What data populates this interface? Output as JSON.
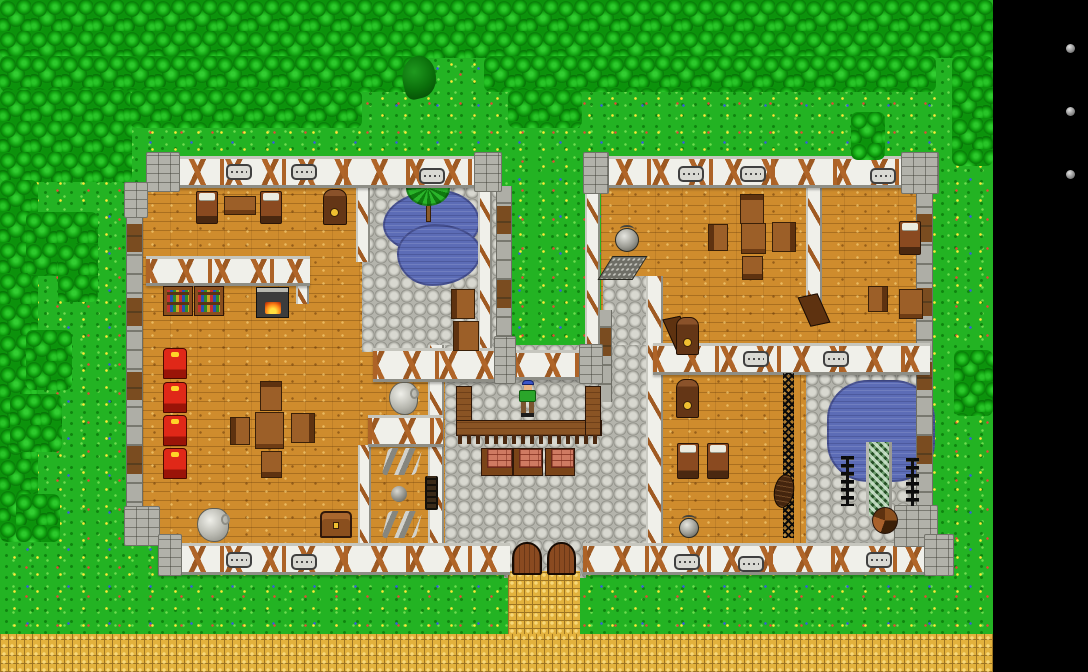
{
  "meta": {
    "description": "Top-down tile RPG scene: timber-framed building complex in a forest clearing with market hall, bedrooms, library, ponds and a villager",
    "viewport": {
      "width": 1088,
      "height": 672
    },
    "map_area": {
      "width": 993,
      "height": 672
    }
  },
  "palette": {
    "grass": "#23b323",
    "tree": "#0c930c",
    "wood_floor": "#cf8c2d",
    "cobble": "#b4b4ac",
    "wall_plaster": "#f0f0ea",
    "wall_brace": "#ad6327",
    "stone": "#aeaea6",
    "water": "#5c6cb6",
    "path": "#e3b23d",
    "panel": "#000000",
    "panel_dot": "#909090",
    "avatar_cap": "#3a55c8",
    "avatar_shirt": "#2aa52a",
    "avatar_pants": "#7a5530",
    "accent_red": "#e02818",
    "accent_gold": "#f0c030"
  },
  "sidebar": {
    "background": "#000000",
    "buttons": [
      {
        "label": "orb-button-1",
        "x": 1066,
        "y": 44,
        "size": 9
      },
      {
        "label": "orb-button-2",
        "x": 1066,
        "y": 107,
        "size": 9
      },
      {
        "label": "orb-button-3",
        "x": 1066,
        "y": 170,
        "size": 9
      }
    ]
  },
  "entities": [
    {
      "t": "floor-wood",
      "x": 143,
      "y": 186,
      "w": 302,
      "h": 360
    },
    {
      "t": "floor-cobble",
      "x": 362,
      "y": 186,
      "w": 150,
      "h": 166
    },
    {
      "t": "floor-wood",
      "x": 601,
      "y": 186,
      "w": 317,
      "h": 164
    },
    {
      "t": "floor-cobble",
      "x": 603,
      "y": 276,
      "w": 45,
      "h": 124
    },
    {
      "t": "floor-wood",
      "x": 661,
      "y": 373,
      "w": 132,
      "h": 173
    },
    {
      "t": "floor-wood-v",
      "x": 793,
      "y": 373,
      "w": 16,
      "h": 173
    },
    {
      "t": "floor-cobble",
      "x": 806,
      "y": 373,
      "w": 127,
      "h": 173
    },
    {
      "t": "floor-cobble",
      "x": 445,
      "y": 345,
      "w": 212,
      "h": 201
    },
    {
      "t": "floor-cobble",
      "x": 504,
      "y": 540,
      "w": 82,
      "h": 38
    },
    {
      "t": "path",
      "x": 508,
      "y": 571,
      "w": 72,
      "h": 66
    },
    {
      "t": "path",
      "x": 0,
      "y": 634,
      "w": 993,
      "h": 38
    },
    {
      "t": "pond-a",
      "x": 383,
      "y": 190,
      "w": 97,
      "h": 64
    },
    {
      "t": "pond-b",
      "x": 397,
      "y": 224,
      "w": 84,
      "h": 62
    },
    {
      "t": "pond-c",
      "x": 827,
      "y": 380,
      "w": 108,
      "h": 102
    },
    {
      "t": "palm-tree",
      "x": 406,
      "y": 170,
      "w": 44,
      "h": 52
    },
    {
      "t": "wall-stone",
      "x": 126,
      "y": 184,
      "w": 17,
      "h": 336
    },
    {
      "t": "wall-stone",
      "x": 916,
      "y": 184,
      "w": 17,
      "h": 326
    },
    {
      "t": "wall-stone2",
      "x": 496,
      "y": 186,
      "w": 16,
      "h": 168
    },
    {
      "t": "wall-stone2",
      "x": 598,
      "y": 310,
      "w": 14,
      "h": 92
    },
    {
      "t": "wall-v",
      "x": 356,
      "y": 186,
      "w": 14,
      "h": 76
    },
    {
      "t": "wall-v",
      "x": 478,
      "y": 186,
      "w": 14,
      "h": 166
    },
    {
      "t": "wall-v",
      "x": 585,
      "y": 190,
      "w": 15,
      "h": 162
    },
    {
      "t": "wall-v",
      "x": 428,
      "y": 345,
      "w": 16,
      "h": 200
    },
    {
      "t": "wall-v",
      "x": 646,
      "y": 276,
      "w": 17,
      "h": 269
    },
    {
      "t": "wall-v",
      "x": 806,
      "y": 158,
      "w": 16,
      "h": 148
    },
    {
      "t": "wall-v",
      "x": 358,
      "y": 445,
      "w": 13,
      "h": 100
    },
    {
      "t": "wall-v",
      "x": 296,
      "y": 256,
      "w": 13,
      "h": 48
    },
    {
      "t": "wall-h",
      "x": 158,
      "y": 156,
      "w": 334,
      "h": 32
    },
    {
      "t": "wall-h",
      "x": 585,
      "y": 156,
      "w": 350,
      "h": 32
    },
    {
      "t": "wall-h",
      "x": 146,
      "y": 256,
      "w": 164,
      "h": 30
    },
    {
      "t": "wall-h",
      "x": 373,
      "y": 348,
      "w": 140,
      "h": 34
    },
    {
      "t": "wall-h",
      "x": 513,
      "y": 350,
      "w": 88,
      "h": 30
    },
    {
      "t": "wall-h",
      "x": 653,
      "y": 343,
      "w": 277,
      "h": 32
    },
    {
      "t": "wall-h",
      "x": 368,
      "y": 415,
      "w": 75,
      "h": 32
    },
    {
      "t": "wall-h",
      "x": 158,
      "y": 543,
      "w": 352,
      "h": 32
    },
    {
      "t": "wall-h",
      "x": 583,
      "y": 543,
      "w": 352,
      "h": 32
    },
    {
      "t": "stone-block",
      "x": 146,
      "y": 152,
      "w": 34,
      "h": 40
    },
    {
      "t": "stone-block",
      "x": 124,
      "y": 182,
      "w": 24,
      "h": 36
    },
    {
      "t": "stone-block",
      "x": 124,
      "y": 506,
      "w": 36,
      "h": 40
    },
    {
      "t": "stone-block",
      "x": 158,
      "y": 534,
      "w": 24,
      "h": 42
    },
    {
      "t": "stone-block",
      "x": 474,
      "y": 152,
      "w": 28,
      "h": 40
    },
    {
      "t": "stone-block",
      "x": 583,
      "y": 152,
      "w": 26,
      "h": 42
    },
    {
      "t": "stone-block",
      "x": 901,
      "y": 152,
      "w": 38,
      "h": 42
    },
    {
      "t": "stone-block",
      "x": 894,
      "y": 505,
      "w": 44,
      "h": 42
    },
    {
      "t": "stone-block",
      "x": 924,
      "y": 534,
      "w": 30,
      "h": 42
    },
    {
      "t": "stone-block",
      "x": 494,
      "y": 336,
      "w": 22,
      "h": 48
    },
    {
      "t": "stone-block",
      "x": 579,
      "y": 344,
      "w": 24,
      "h": 40
    },
    {
      "t": "window",
      "x": 226,
      "y": 164,
      "w": 26,
      "h": 16
    },
    {
      "t": "window",
      "x": 291,
      "y": 164,
      "w": 26,
      "h": 16
    },
    {
      "t": "window",
      "x": 419,
      "y": 168,
      "w": 26,
      "h": 16
    },
    {
      "t": "window",
      "x": 678,
      "y": 166,
      "w": 26,
      "h": 16
    },
    {
      "t": "window",
      "x": 740,
      "y": 166,
      "w": 26,
      "h": 16
    },
    {
      "t": "window",
      "x": 870,
      "y": 168,
      "w": 26,
      "h": 16
    },
    {
      "t": "window",
      "x": 743,
      "y": 351,
      "w": 26,
      "h": 16
    },
    {
      "t": "window",
      "x": 823,
      "y": 351,
      "w": 26,
      "h": 16
    },
    {
      "t": "window",
      "x": 226,
      "y": 552,
      "w": 26,
      "h": 16
    },
    {
      "t": "window",
      "x": 291,
      "y": 554,
      "w": 26,
      "h": 16
    },
    {
      "t": "window",
      "x": 674,
      "y": 554,
      "w": 26,
      "h": 16
    },
    {
      "t": "window",
      "x": 738,
      "y": 556,
      "w": 26,
      "h": 16
    },
    {
      "t": "window",
      "x": 866,
      "y": 552,
      "w": 26,
      "h": 16
    },
    {
      "t": "open-door",
      "x": 804,
      "y": 294,
      "w": 20,
      "h": 32
    },
    {
      "t": "open-door",
      "x": 670,
      "y": 316,
      "w": 18,
      "h": 38
    },
    {
      "t": "bed",
      "x": 196,
      "y": 191,
      "w": 22,
      "h": 33
    },
    {
      "t": "side-table",
      "x": 224,
      "y": 196,
      "w": 32,
      "h": 19
    },
    {
      "t": "bed",
      "x": 260,
      "y": 191,
      "w": 22,
      "h": 33
    },
    {
      "t": "clock",
      "x": 323,
      "y": 189,
      "w": 24,
      "h": 36
    },
    {
      "t": "bookshelf",
      "x": 163,
      "y": 286,
      "w": 30,
      "h": 30
    },
    {
      "t": "bookshelf",
      "x": 194,
      "y": 286,
      "w": 30,
      "h": 30
    },
    {
      "t": "stove",
      "x": 256,
      "y": 287,
      "w": 33,
      "h": 31
    },
    {
      "t": "red-chair",
      "x": 163,
      "y": 348,
      "w": 24,
      "h": 31
    },
    {
      "t": "red-chair",
      "x": 163,
      "y": 382,
      "w": 24,
      "h": 31
    },
    {
      "t": "red-chair",
      "x": 163,
      "y": 415,
      "w": 24,
      "h": 31
    },
    {
      "t": "red-chair",
      "x": 163,
      "y": 448,
      "w": 24,
      "h": 31
    },
    {
      "t": "chair-n",
      "x": 260,
      "y": 381,
      "w": 22,
      "h": 30
    },
    {
      "t": "chair-w",
      "x": 230,
      "y": 417,
      "w": 20,
      "h": 28
    },
    {
      "t": "table",
      "x": 255,
      "y": 412,
      "w": 29,
      "h": 37
    },
    {
      "t": "chair-e",
      "x": 291,
      "y": 413,
      "w": 24,
      "h": 30
    },
    {
      "t": "chair-s",
      "x": 261,
      "y": 451,
      "w": 21,
      "h": 27
    },
    {
      "t": "pitcher",
      "x": 389,
      "y": 382,
      "w": 29,
      "h": 33
    },
    {
      "t": "pitcher",
      "x": 197,
      "y": 508,
      "w": 32,
      "h": 34
    },
    {
      "t": "gray-rolls",
      "x": 385,
      "y": 448,
      "w": 34,
      "h": 27
    },
    {
      "t": "gray-rolls",
      "x": 385,
      "y": 511,
      "w": 34,
      "h": 27
    },
    {
      "t": "ball",
      "x": 391,
      "y": 486,
      "w": 16,
      "h": 16
    },
    {
      "t": "ladder",
      "x": 425,
      "y": 476,
      "w": 13,
      "h": 34
    },
    {
      "t": "chest",
      "x": 320,
      "y": 511,
      "w": 32,
      "h": 27
    },
    {
      "t": "chair-w",
      "x": 451,
      "y": 289,
      "w": 24,
      "h": 30
    },
    {
      "t": "chair-w",
      "x": 453,
      "y": 321,
      "w": 26,
      "h": 30
    },
    {
      "t": "counter-l",
      "x": 456,
      "y": 386,
      "w": 16,
      "h": 50
    },
    {
      "t": "counter-b",
      "x": 456,
      "y": 420,
      "w": 146,
      "h": 16
    },
    {
      "t": "counter-r",
      "x": 585,
      "y": 386,
      "w": 16,
      "h": 50
    },
    {
      "t": "fringe",
      "x": 458,
      "y": 435,
      "w": 142,
      "h": 9
    },
    {
      "t": "stall",
      "x": 481,
      "y": 448,
      "w": 32,
      "h": 28
    },
    {
      "t": "stall",
      "x": 513,
      "y": 448,
      "w": 30,
      "h": 28
    },
    {
      "t": "stall",
      "x": 545,
      "y": 448,
      "w": 30,
      "h": 28
    },
    {
      "t": "door-arch",
      "x": 512,
      "y": 542,
      "w": 30,
      "h": 33
    },
    {
      "t": "door-arch",
      "x": 547,
      "y": 542,
      "w": 29,
      "h": 33
    },
    {
      "t": "cauldron",
      "x": 615,
      "y": 228,
      "w": 24,
      "h": 24
    },
    {
      "t": "floor-grate",
      "x": 605,
      "y": 256,
      "w": 35,
      "h": 24
    },
    {
      "t": "chair-n",
      "x": 740,
      "y": 194,
      "w": 24,
      "h": 30
    },
    {
      "t": "chair-w",
      "x": 708,
      "y": 224,
      "w": 20,
      "h": 27
    },
    {
      "t": "table",
      "x": 741,
      "y": 223,
      "w": 25,
      "h": 31
    },
    {
      "t": "chair-e",
      "x": 772,
      "y": 222,
      "w": 24,
      "h": 30
    },
    {
      "t": "chair-s",
      "x": 742,
      "y": 256,
      "w": 21,
      "h": 24
    },
    {
      "t": "clock",
      "x": 676,
      "y": 317,
      "w": 23,
      "h": 38
    },
    {
      "t": "bed",
      "x": 899,
      "y": 221,
      "w": 22,
      "h": 34
    },
    {
      "t": "chair-e",
      "x": 868,
      "y": 286,
      "w": 20,
      "h": 26
    },
    {
      "t": "desk",
      "x": 899,
      "y": 289,
      "w": 24,
      "h": 30
    },
    {
      "t": "clock",
      "x": 676,
      "y": 379,
      "w": 23,
      "h": 39
    },
    {
      "t": "bed",
      "x": 677,
      "y": 443,
      "w": 22,
      "h": 36
    },
    {
      "t": "bed",
      "x": 707,
      "y": 443,
      "w": 22,
      "h": 36
    },
    {
      "t": "cauldron",
      "x": 679,
      "y": 518,
      "w": 20,
      "h": 20
    },
    {
      "t": "trellis",
      "x": 783,
      "y": 373,
      "w": 11,
      "h": 165
    },
    {
      "t": "canoe",
      "x": 774,
      "y": 474,
      "w": 20,
      "h": 34
    },
    {
      "t": "hedge-column",
      "x": 866,
      "y": 442,
      "w": 26,
      "h": 74
    },
    {
      "t": "spike-fence",
      "x": 841,
      "y": 456,
      "w": 13,
      "h": 50
    },
    {
      "t": "spike-fence",
      "x": 906,
      "y": 458,
      "w": 13,
      "h": 48
    },
    {
      "t": "spiral-stairs",
      "x": 872,
      "y": 507,
      "w": 26,
      "h": 27
    },
    {
      "t": "avatar",
      "x": 516,
      "y": 380,
      "w": 24,
      "h": 40
    },
    {
      "t": "trees",
      "x": 0,
      "y": 0,
      "w": 993,
      "h": 58
    },
    {
      "t": "trees",
      "x": 0,
      "y": 56,
      "w": 425,
      "h": 36
    },
    {
      "t": "trees",
      "x": 484,
      "y": 56,
      "w": 452,
      "h": 36
    },
    {
      "t": "trees",
      "x": 952,
      "y": 56,
      "w": 41,
      "h": 110
    },
    {
      "t": "trees",
      "x": 0,
      "y": 90,
      "w": 132,
      "h": 92
    },
    {
      "t": "trees",
      "x": 130,
      "y": 90,
      "w": 232,
      "h": 38
    },
    {
      "t": "trees",
      "x": 508,
      "y": 90,
      "w": 74,
      "h": 38
    },
    {
      "t": "trees",
      "x": 851,
      "y": 112,
      "w": 34,
      "h": 48
    },
    {
      "t": "trees",
      "x": 0,
      "y": 180,
      "w": 38,
      "h": 362
    },
    {
      "t": "trees",
      "x": 26,
      "y": 212,
      "w": 72,
      "h": 64
    },
    {
      "t": "trees",
      "x": 58,
      "y": 244,
      "w": 40,
      "h": 58
    },
    {
      "t": "trees",
      "x": 26,
      "y": 330,
      "w": 46,
      "h": 60
    },
    {
      "t": "trees",
      "x": 10,
      "y": 394,
      "w": 52,
      "h": 58
    },
    {
      "t": "trees",
      "x": 16,
      "y": 494,
      "w": 44,
      "h": 48
    },
    {
      "t": "trees",
      "x": 954,
      "y": 350,
      "w": 39,
      "h": 66
    },
    {
      "t": "lone-tree",
      "x": 402,
      "y": 56,
      "w": 34,
      "h": 42
    },
    {
      "t": "ui-dot",
      "x": 1066,
      "y": 44,
      "w": 9,
      "h": 9
    },
    {
      "t": "ui-dot",
      "x": 1066,
      "y": 107,
      "w": 9,
      "h": 9
    },
    {
      "t": "ui-dot",
      "x": 1066,
      "y": 170,
      "w": 9,
      "h": 9
    }
  ]
}
